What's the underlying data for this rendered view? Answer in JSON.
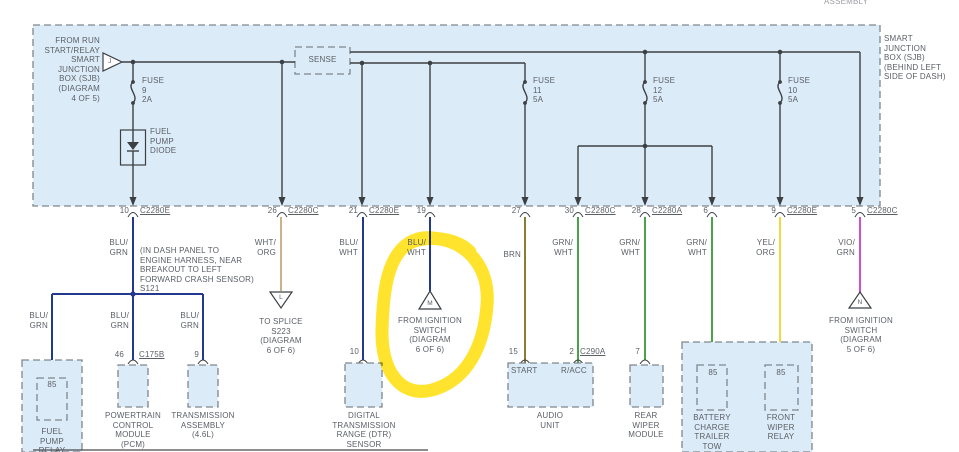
{
  "header": {
    "cut_text": "ASSEMBLY"
  },
  "sjb": {
    "source_note": "FROM RUN\nSTART/RELAY\nSMART\nJUNCTION\nBOX (SJB)\n(DIAGRAM\n4 OF 5)",
    "connector_j": "J",
    "sense_label": "SENSE",
    "fuse_9": "FUSE\n9\n2A",
    "fuse_11": "FUSE\n11\n5A",
    "fuse_12": "FUSE\n12\n5A",
    "fuse_10": "FUSE\n10\n5A",
    "diode_label": "FUEL\nPUMP\nDIODE",
    "location_note": "SMART\nJUNCTION\nBOX (SJB)\n(BEHIND LEFT\nSIDE OF DASH)"
  },
  "pins_row1": [
    {
      "num": "10",
      "conn": "C2280E"
    },
    {
      "num": "26",
      "conn": "C2280C"
    },
    {
      "num": "21",
      "conn": "C2280E"
    },
    {
      "num": "19",
      "conn": ""
    },
    {
      "num": "27",
      "conn": ""
    },
    {
      "num": "30",
      "conn": "C2280C"
    },
    {
      "num": "28",
      "conn": "C2280A"
    },
    {
      "num": "6",
      "conn": ""
    },
    {
      "num": "9",
      "conn": "C2280E"
    },
    {
      "num": "5",
      "conn": "C2280C"
    }
  ],
  "wire_labels": [
    "BLU/\nGRN",
    "WHT/\nORG",
    "BLU/\nWHT",
    "BLU/\nWHT",
    "BRN",
    "GRN/\nWHT",
    "GRN/\nWHT",
    "GRN/\nWHT",
    "YEL/\nORG",
    "VIO/\nGRN"
  ],
  "splice": {
    "note": "(IN DASH PANEL TO\nENGINE HARNESS, NEAR\nBREAKOUT TO LEFT\nFORWARD CRASH SENSOR)\nS121",
    "branch_labels": [
      "BLU/\nGRN",
      "BLU/\nGRN",
      "BLU/\nGRN"
    ]
  },
  "pins_row2": {
    "fuel_85": "85",
    "pcm_num": "46",
    "pcm_conn": "C175B",
    "trans_num": "9",
    "dtr_num": "10",
    "audio_start_num": "15",
    "audio_start": "START",
    "audio_racc_num": "2",
    "audio_racc_conn": "C290A",
    "audio_racc": "R/ACC",
    "rear_num": "7",
    "batt_85": "85",
    "front_85": "85"
  },
  "components": {
    "fuel_pump_relay": "FUEL\nPUMP\nRELAY",
    "pcm": "POWERTRAIN\nCONTROL\nMODULE\n(PCM)",
    "transmission": "TRANSMISSION\nASSEMBLY\n(4.6L)",
    "dtr": "DIGITAL\nTRANSMISSION\nRANGE (DTR)\nSENSOR",
    "audio": "AUDIO\nUNIT",
    "rear_wiper": "REAR\nWIPER\nMODULE",
    "battery_charge": "BATTERY\nCHARGE\nTRAILER\nTOW",
    "front_wiper": "FRONT\nWIPER\nRELAY"
  },
  "offpage": {
    "to_splice": "TO SPLICE\nS223\n(DIAGRAM\n6 OF 6)",
    "ignition_m": "FROM IGNITION\nSWITCH\n(DIAGRAM\n6 OF 6)",
    "ignition_n": "FROM IGNITION\nSWITCH\n(DIAGRAM\n5 OF 6)",
    "tri_l": "L",
    "tri_m": "M",
    "tri_n": "N"
  },
  "colors": {
    "box_fill": "#dcebf8",
    "line": "#3c4043",
    "wire_blu": "#24388f",
    "wire_tan": "#c9b387",
    "wire_brn": "#8a7c33",
    "wire_grn": "#4aa24a",
    "wire_yel": "#f0d93e",
    "wire_vio": "#cf4fd1",
    "highlight": "#ffe11a"
  }
}
